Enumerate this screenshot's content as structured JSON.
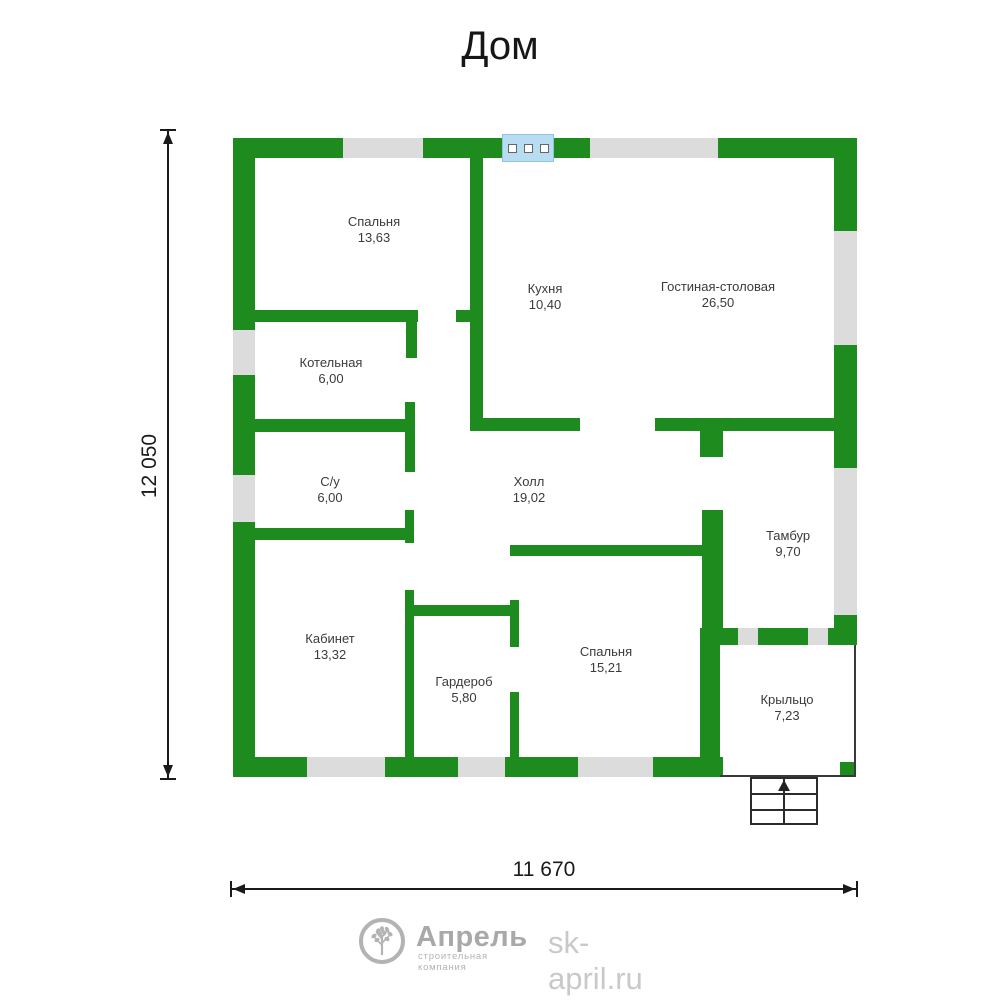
{
  "title": "Дом",
  "rooms": [
    {
      "name": "Спальня",
      "area": "13,63"
    },
    {
      "name": "Кухня",
      "area": "10,40"
    },
    {
      "name": "Гостиная-столовая",
      "area": "26,50"
    },
    {
      "name": "Котельная",
      "area": "6,00"
    },
    {
      "name": "С/у",
      "area": "6,00"
    },
    {
      "name": "Холл",
      "area": "19,02"
    },
    {
      "name": "Тамбур",
      "area": "9,70"
    },
    {
      "name": "Кабинет",
      "area": "13,32"
    },
    {
      "name": "Гардероб",
      "area": "5,80"
    },
    {
      "name": "Спальня",
      "area": "15,21"
    },
    {
      "name": "Крыльцо",
      "area": "7,23"
    }
  ],
  "dimensions": {
    "height_label": "12 050",
    "width_label": "11 670"
  },
  "logo": {
    "brand": "Апрель",
    "tagline": "строительная компания",
    "website": "sk-april.ru"
  },
  "colors": {
    "wall_green": "#1e8b1e",
    "window_gray": "#dcdcdc",
    "window_blue": "#b8ddf2",
    "dim_ink": "#1a1a1a",
    "logo_gray": "#a9a9a9",
    "logo_light_gray": "#c9c9c9"
  }
}
